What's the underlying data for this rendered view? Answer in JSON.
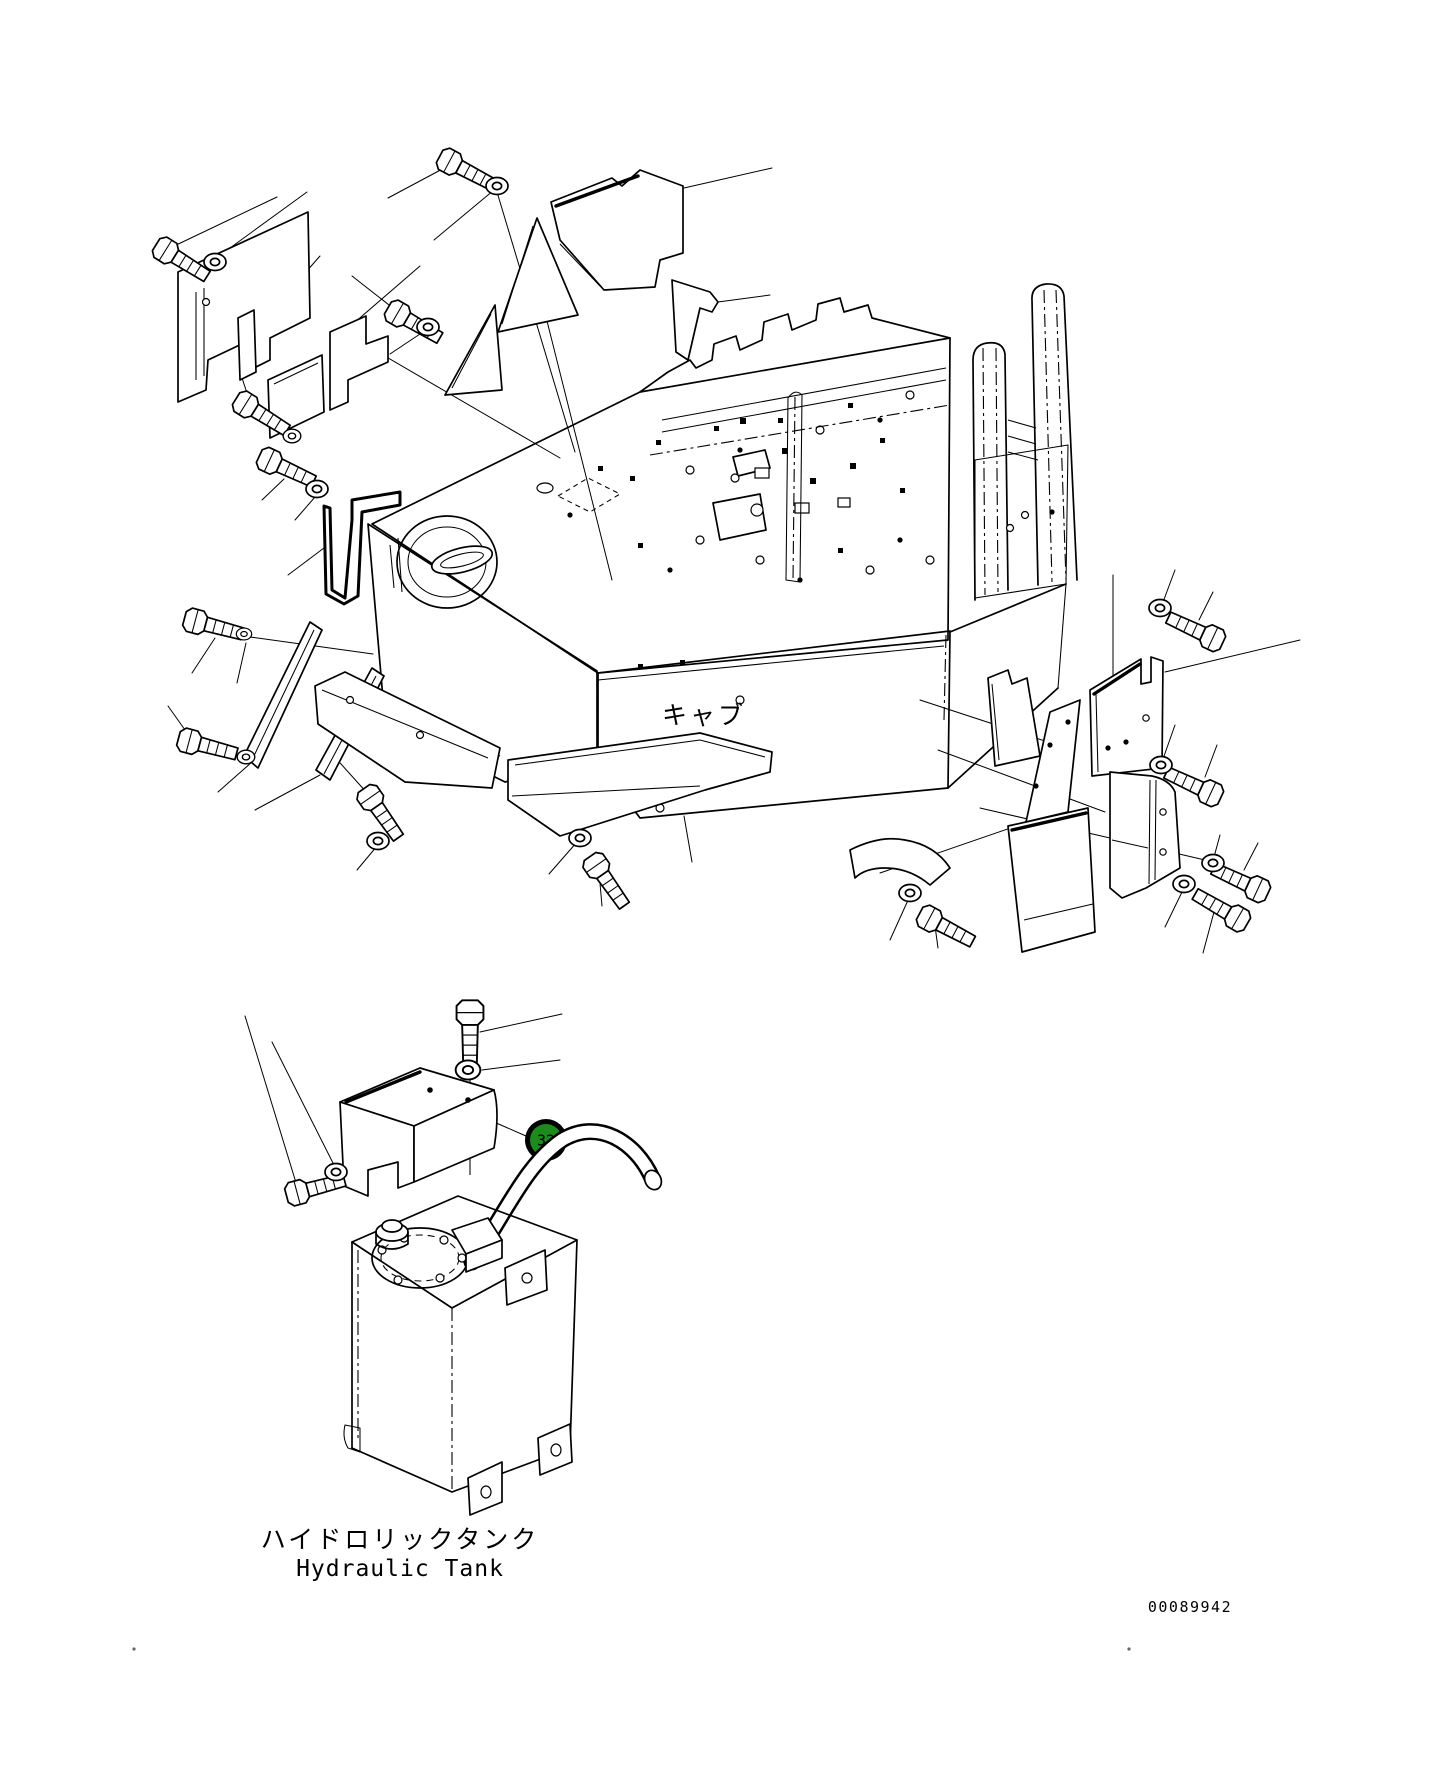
{
  "labels": {
    "cab_ja": "キャブ",
    "cab_en": "Cab",
    "hydraulic_tank_ja": "ハイドロリックタンク",
    "hydraulic_tank_en": "Hydraulic Tank"
  },
  "callout": {
    "number": "32",
    "fill": "#1c8a1c",
    "ring_color": "#000000",
    "text_color": "#ffffff"
  },
  "drawing_number": "00089942",
  "colors": {
    "line": "#000000",
    "background": "#ffffff"
  }
}
